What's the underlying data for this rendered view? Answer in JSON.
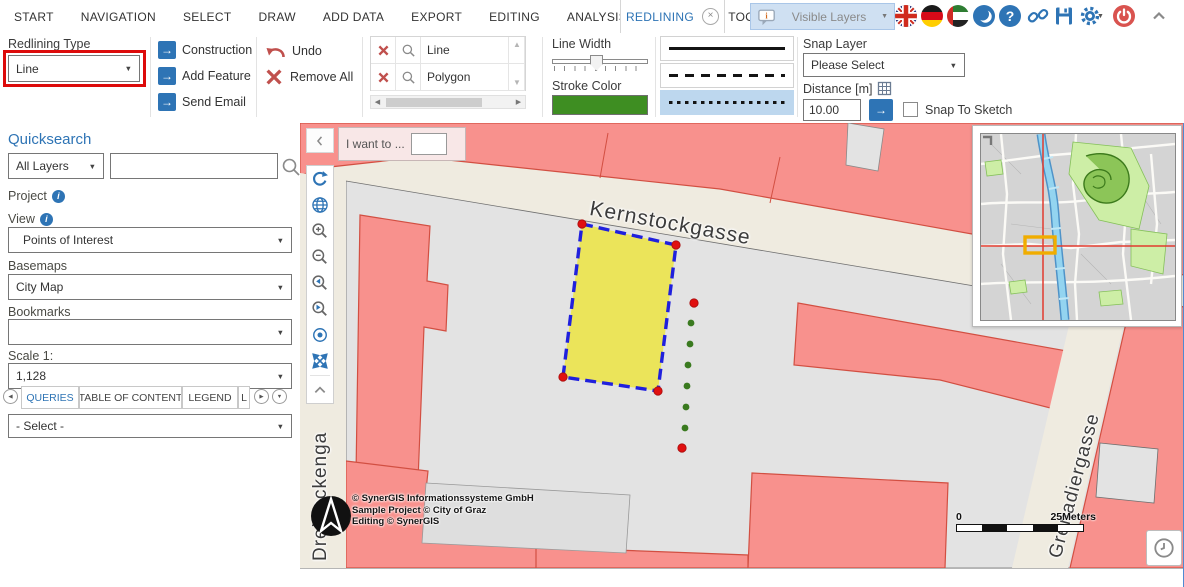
{
  "topbar": {
    "menu_items": [
      "START",
      "NAVIGATION",
      "SELECT",
      "DRAW",
      "ADD DATA",
      "EXPORT",
      "EDITING",
      "ANALYSIS",
      "REMAINING TOOLS"
    ],
    "active_tab": "REDLINING",
    "visible_layers_label": "Visible Layers",
    "icons": [
      "speech-bubble",
      "uk-flag",
      "german-flag",
      "uae-flag",
      "night-mode",
      "help",
      "share-link",
      "save",
      "settings",
      "power",
      "collapse-up"
    ]
  },
  "ribbon": {
    "redlining_type": {
      "label": "Redlining Type",
      "value": "Line"
    },
    "actions": {
      "construction": "Construction",
      "add_feature": "Add Feature",
      "send_email": "Send Email",
      "undo": "Undo",
      "remove_all": "Remove All"
    },
    "redline_items": [
      {
        "name": "Line"
      },
      {
        "name": "Polygon"
      }
    ],
    "line_width_label": "Line Width",
    "stroke_color": {
      "label": "Stroke Color",
      "value": "#3e8e22"
    },
    "line_styles": [
      "solid",
      "dashed",
      "dotted"
    ],
    "selected_line_style": "dotted",
    "snap": {
      "layer_label": "Snap Layer",
      "layer_value": "Please Select",
      "distance_label": "Distance [m]",
      "distance_value": "10.00",
      "snap_to_sketch_label": "Snap To Sketch"
    }
  },
  "sidebar": {
    "quicksearch": {
      "title": "Quicksearch",
      "scope": "All Layers",
      "search_value": ""
    },
    "project_label": "Project",
    "view": {
      "label": "View",
      "value": "Points of Interest"
    },
    "basemaps": {
      "label": "Basemaps",
      "value": "City Map"
    },
    "bookmarks": {
      "label": "Bookmarks",
      "value": ""
    },
    "scale": {
      "label": "Scale 1:",
      "value": "1,128"
    },
    "tabs": [
      "QUERIES",
      "TABLE OF CONTENT",
      "LEGEND",
      "L"
    ],
    "active_tab": "QUERIES",
    "queries_select_value": "- Select -"
  },
  "map": {
    "i_want_to_label": "I want to ...",
    "streets": {
      "kernstockgasse": "Kernstockgasse",
      "dreihackengasse": "Dreihackenga",
      "grenadiergasse": "Grenadiergasse"
    },
    "copyright": [
      "© SynerGIS Informationssysteme GmbH",
      "Sample Project © City of Graz",
      "Editing © SynerGIS"
    ],
    "scalebar": {
      "start": "0",
      "end": "25Meters"
    },
    "redline": {
      "polygon_fill": "#ebe45a",
      "polygon_stroke": "#2020dd",
      "vertex_color": "#e01010",
      "sketch_dot_color": "#3a7a1f"
    }
  },
  "glyphs": {
    "caret": "▼",
    "arrow": "→",
    "tri_up": "▲",
    "tri_down": "▼",
    "tri_left": "◀",
    "tri_right": "▶",
    "question": "?",
    "info": "i",
    "close": "×"
  },
  "colors": {
    "accent": "#2e74b5",
    "annotation_red": "#dd0b0b",
    "selection_blue": "#bdd7ee",
    "danger_red": "#c0504d",
    "building_pink": "#f8918d",
    "parcel_gray": "#e3e3e3",
    "street_beige": "#efebe0"
  }
}
